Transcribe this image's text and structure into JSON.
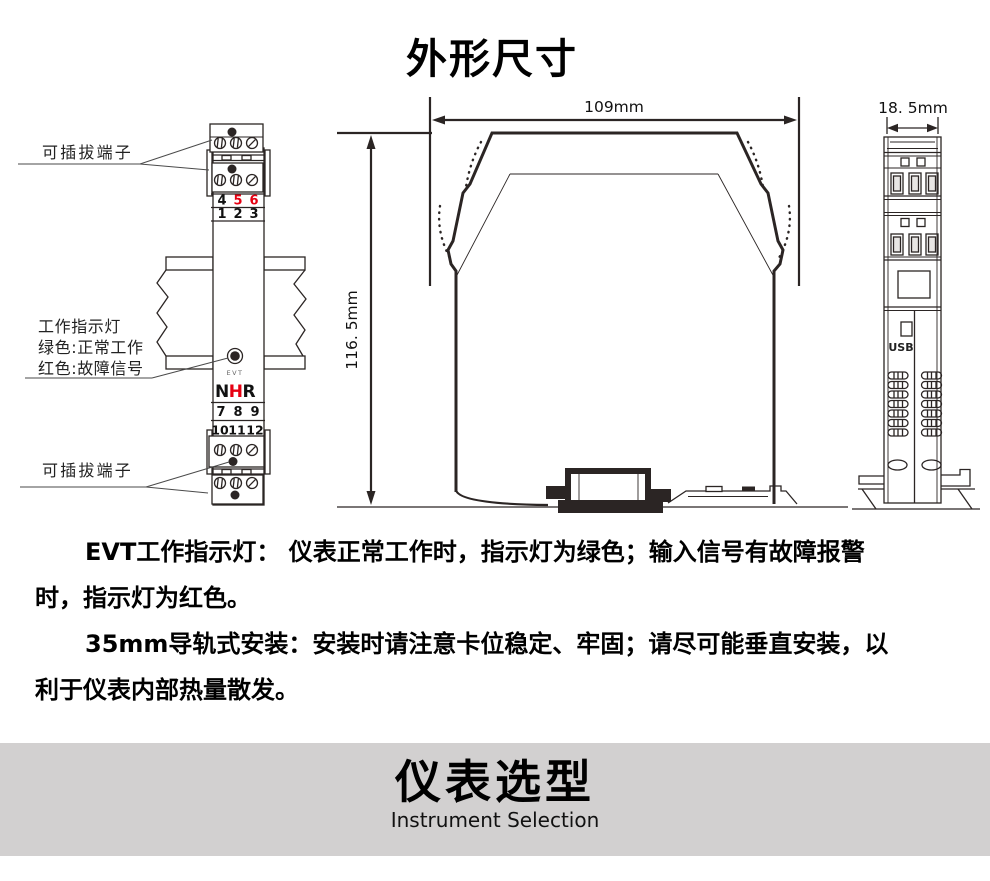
{
  "page": {
    "title": "外形尺寸"
  },
  "colors": {
    "red": "#e60012",
    "line": "#2b2524",
    "banner_bg": "#d2d0d0"
  },
  "front_view": {
    "label_terminal_top": "可插拔端子",
    "label_terminal_bottom": "可插拔端子",
    "indicator_label_line1": "工作指示灯",
    "indicator_label_line2": "绿色:正常工作",
    "indicator_label_line3": "红色:故障信号",
    "evt_label": "EVT",
    "logo": {
      "n": "N",
      "h": "H",
      "r": "R"
    },
    "terminal_numbers": {
      "row_456": [
        "4",
        "5",
        "6"
      ],
      "row_123": [
        "1",
        "2",
        "3"
      ],
      "row_789": [
        "7",
        "8",
        "9"
      ],
      "row_101112": [
        "10",
        "11",
        "12"
      ]
    }
  },
  "side_view": {
    "width_dim": "109mm",
    "height_dim": "116. 5mm"
  },
  "profile_view": {
    "width_dim": "18. 5mm",
    "usb_label": "USB"
  },
  "notes": {
    "paragraph1": "EVT工作指示灯： 仪表正常工作时，指示灯为绿色；输入信号有故障报警时，指示灯为红色。",
    "paragraph2": "35mm导轨式安装：安装时请注意卡位稳定、牢固；请尽可能垂直安装，以利于仪表内部热量散发。"
  },
  "banner": {
    "title": "仪表选型",
    "subtitle": "Instrument Selection"
  }
}
